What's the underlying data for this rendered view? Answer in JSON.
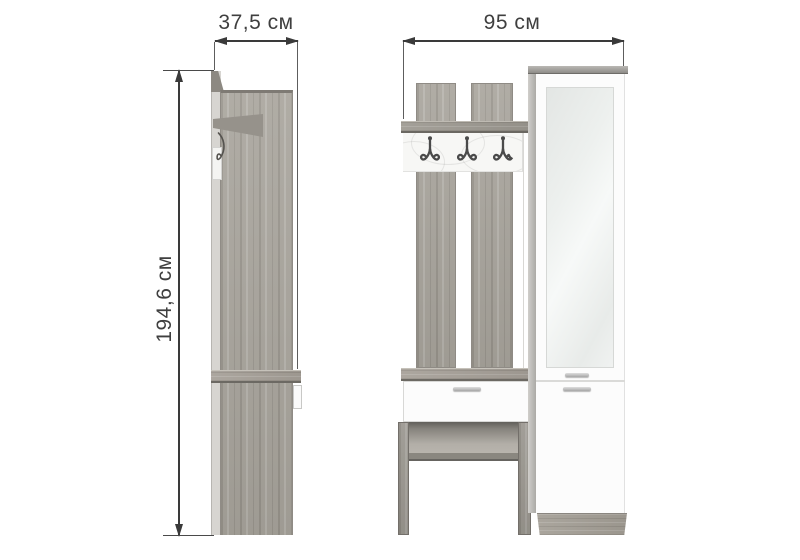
{
  "dimensions": {
    "side_width": "37,5 см",
    "front_width": "95 см",
    "height": "194,6 см"
  },
  "colors": {
    "dimension_lines": "#3a3a3a",
    "label_text": "#3f3f3f",
    "oak_wood": "#a7a39b",
    "wood_edge_dark": "#6c6963",
    "white_facade": "#fcfcfc",
    "mirror_glass": "#edf0ee",
    "metal_hook": "#4a4a4a"
  }
}
